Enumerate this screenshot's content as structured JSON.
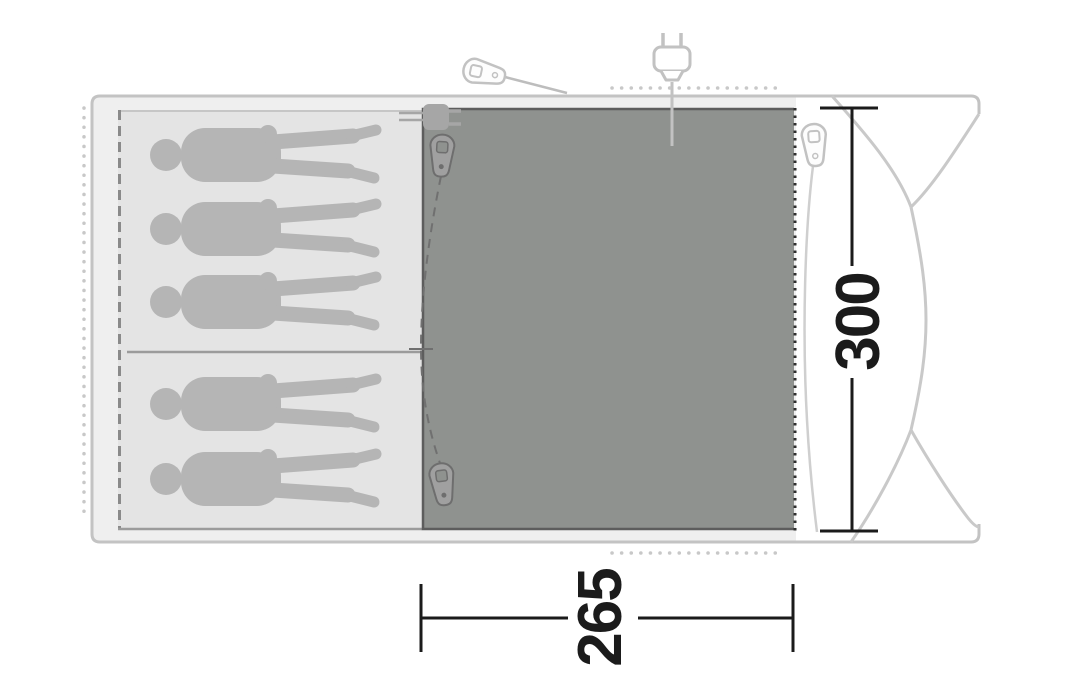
{
  "diagram": {
    "kind": "tent-floor-plan",
    "dimensions": {
      "depth": "300",
      "width": "265"
    },
    "sleeping_area": {
      "total_capacity": 5,
      "sections": [
        {
          "name": "upper-bedroom",
          "capacity": 3
        },
        {
          "name": "lower-bedroom",
          "capacity": 2
        }
      ]
    },
    "icons": {
      "power_plug_top": "power-plug-icon",
      "cable_entry_inner": "cable-entry-plug-icon",
      "zipper_pulls_count": 4
    },
    "colors": {
      "outline": "#c3c3c3",
      "cabin_fill": "#efefef",
      "inner_tent_fill": "#e4e4e4",
      "groundsheet_fill": "#8f928f",
      "figure_fill": "#b5b5b5",
      "zip_dash": "#707070",
      "dimension_ink": "#1b1b1b",
      "dotted_guides": "#c8c8c8"
    }
  }
}
